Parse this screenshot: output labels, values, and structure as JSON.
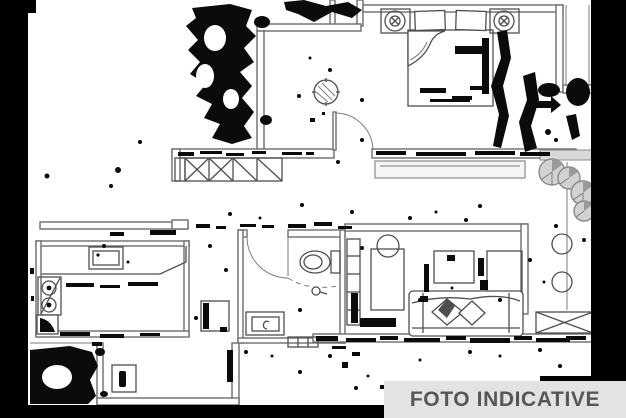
{
  "banner": {
    "label": "FOTO INDICATIVE",
    "background_color": "#e3e3e3",
    "text_color": "#57575a"
  },
  "plan": {
    "kind": "scanned-apartment-floor-plan",
    "background": "#ffffff",
    "wall_color": "#6d6d6d",
    "furniture_color": "#4f4f4f",
    "scan_noise_color": "#0b0b0b",
    "scan_border_color": "#000000",
    "rooms": [
      "bedroom",
      "entry-hall",
      "kitchen",
      "bathroom",
      "living-room",
      "balcony",
      "lower-terrace"
    ],
    "symbols": [
      "double-bed",
      "pillows",
      "bedside-lamps",
      "crossed-wardrobe",
      "hatched-plant",
      "balcony-window",
      "kitchen-sink",
      "cooktop",
      "corner-cabinet",
      "appliance",
      "toilet",
      "shower",
      "washbasin",
      "threshold",
      "bookshelf",
      "desk",
      "chair",
      "coffee-table",
      "cabinet",
      "sofa",
      "throw-pillows",
      "balcony-plants",
      "stools",
      "crossed-unit",
      "door-arcs"
    ]
  }
}
